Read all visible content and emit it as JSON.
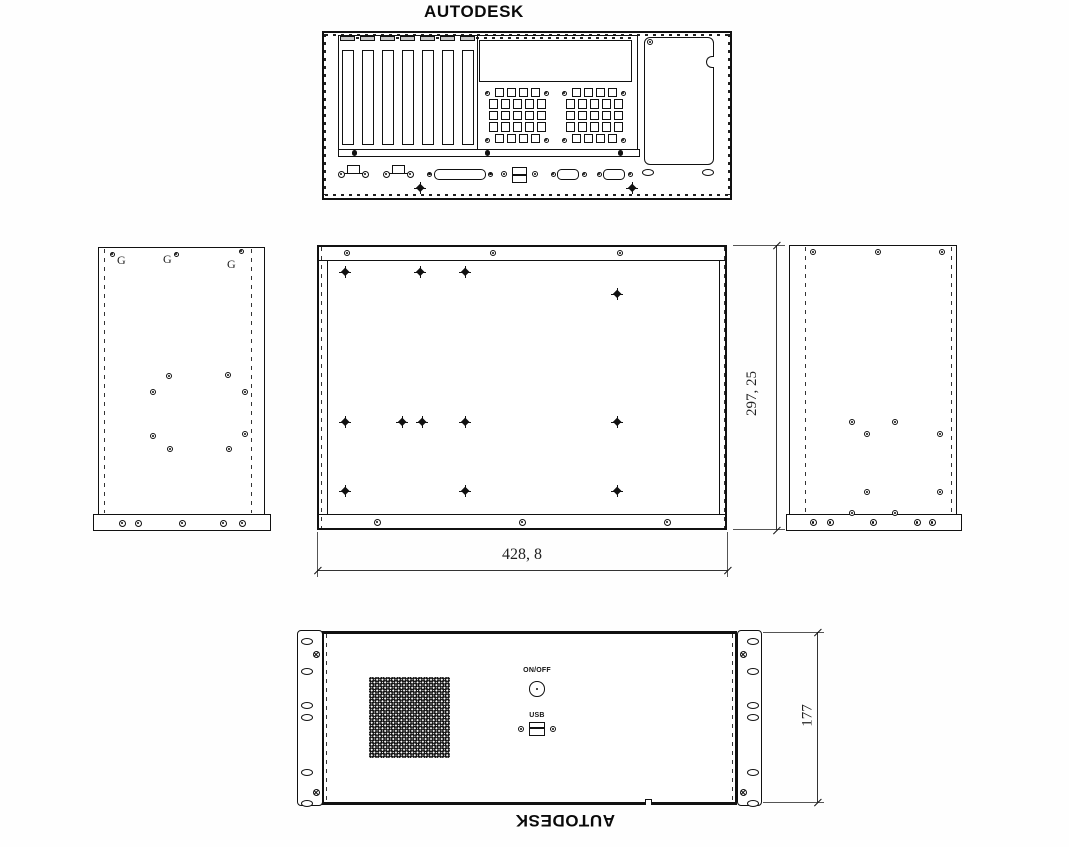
{
  "titles": {
    "top": "AUTODESK",
    "bottom": "AUTODESK"
  },
  "dimensions": {
    "width": "428, 8",
    "depth": "297, 25",
    "height": "177"
  },
  "labels": {
    "ground": "G",
    "power_button": "ON/OFF",
    "usb_port": "USB"
  },
  "colors": {
    "line": "#111111",
    "background": "#ffffff"
  }
}
